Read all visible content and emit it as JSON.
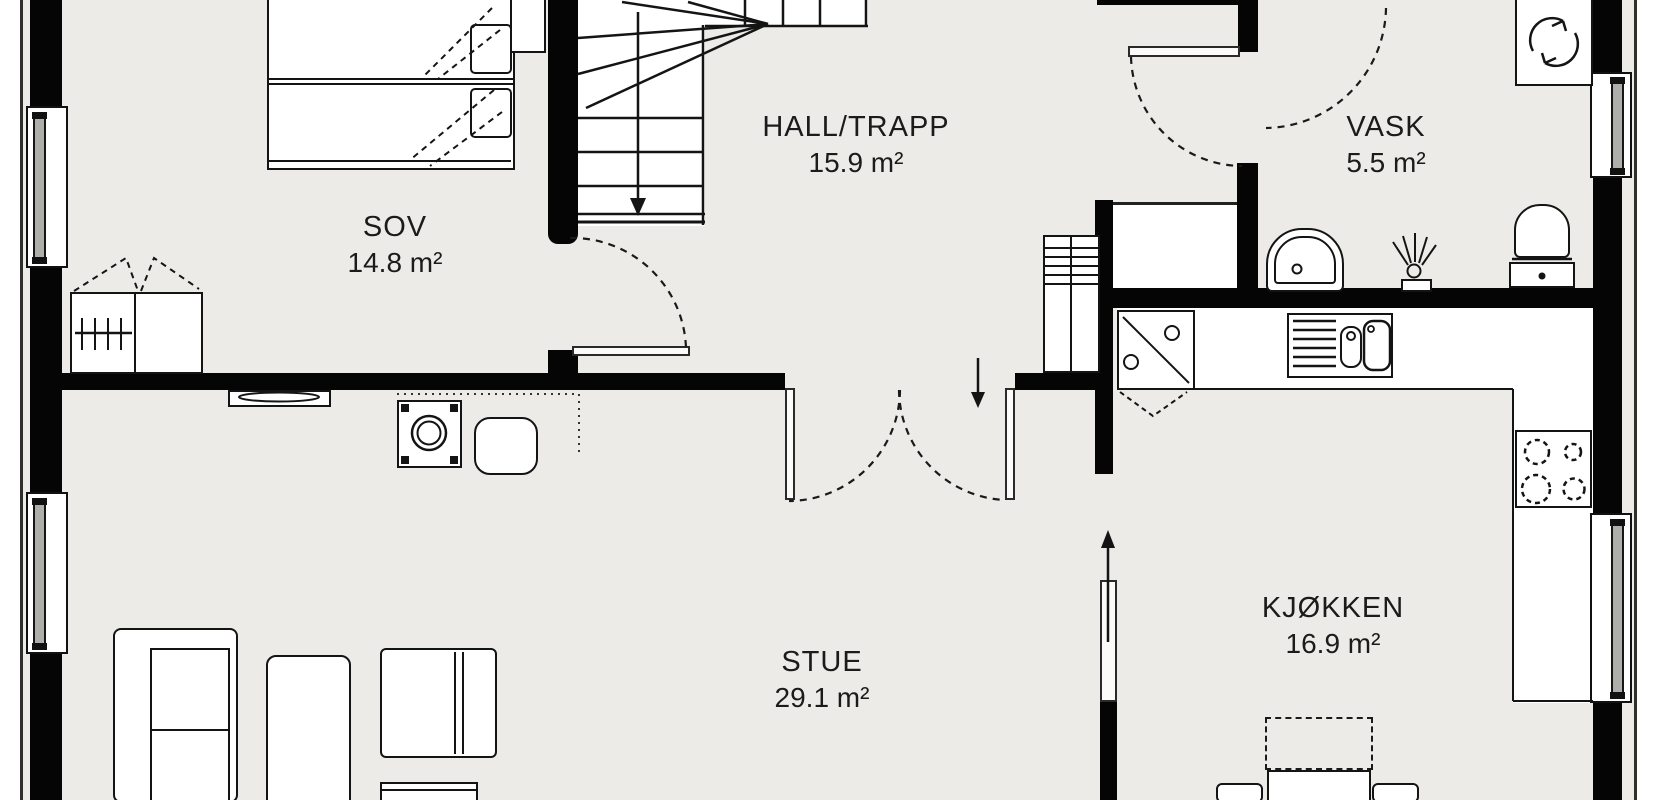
{
  "title": "floor-plan",
  "rooms": {
    "sov": {
      "name": "SOV",
      "area": "14.8 m²"
    },
    "hall": {
      "name": "HALL/TRAPP",
      "area": "15.9 m²"
    },
    "vask": {
      "name": "VASK",
      "area": "5.5 m²"
    },
    "stue": {
      "name": "STUE",
      "area": "29.1 m²"
    },
    "kjokken": {
      "name": "KJØKKEN",
      "area": "16.9 m²"
    }
  },
  "colors": {
    "wall": "#050505",
    "floor": "#edebe7",
    "fixture_fill": "#ffffff",
    "line": "#141414",
    "window_sash": "#aeaeab",
    "text": "#1b1b1b"
  },
  "icons": [
    "stair-down-arrow-icon",
    "door-swing-arc-icon",
    "shower-drain-swirl-icon",
    "cooktop-burners-icon",
    "wood-stove-icon",
    "toilet-icon",
    "washbasin-icon",
    "kitchen-sink-icon",
    "wardrobe-rail-icon"
  ]
}
